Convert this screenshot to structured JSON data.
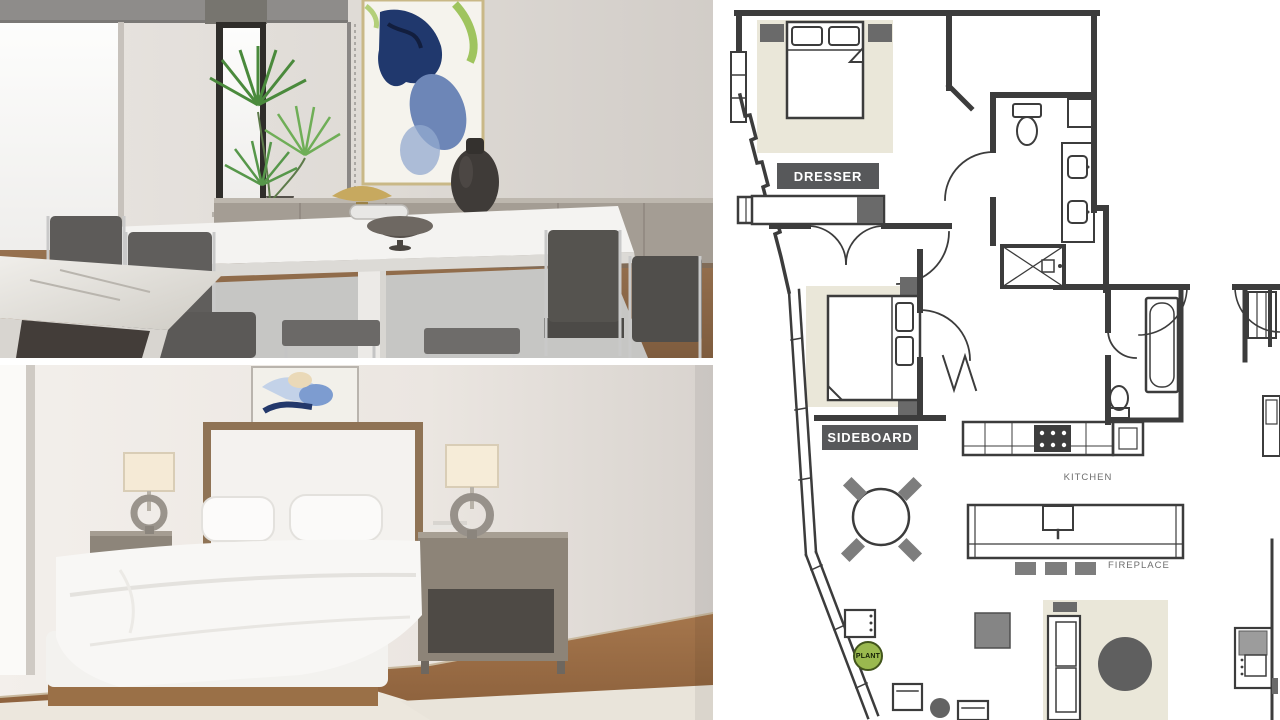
{
  "floor_plan": {
    "labels": {
      "dresser": "DRESSER",
      "sideboard": "SIDEBOARD",
      "kitchen": "KITCHEN",
      "fireplace": "FIREPLACE",
      "plant": "PLANT"
    },
    "colors": {
      "wall_line": "#3c3c3c",
      "label_background": "#57585a",
      "label_text": "#ffffff",
      "area_rug_beige": "#eae7d9",
      "furniture_dark_gray": "#6a6a6a",
      "furniture_mid_gray": "#7d7d7d",
      "plant_green": "#9ab94f",
      "annotation_text_gray": "#6e6e6e"
    }
  },
  "photos": {
    "dining_room": {
      "description": "Staged dining room render: white dining table, grey upholstered chrome chairs, palm plant, abstract blue-green wall art, grey sideboard with brass bowl and dark vase, marble island corner"
    },
    "bedroom": {
      "description": "Staged bedroom render: white platform bed with upholstered headboard, two grey nightstands, sculptural ring lamps, abstract art above bed, wood floor with cream rug"
    }
  }
}
